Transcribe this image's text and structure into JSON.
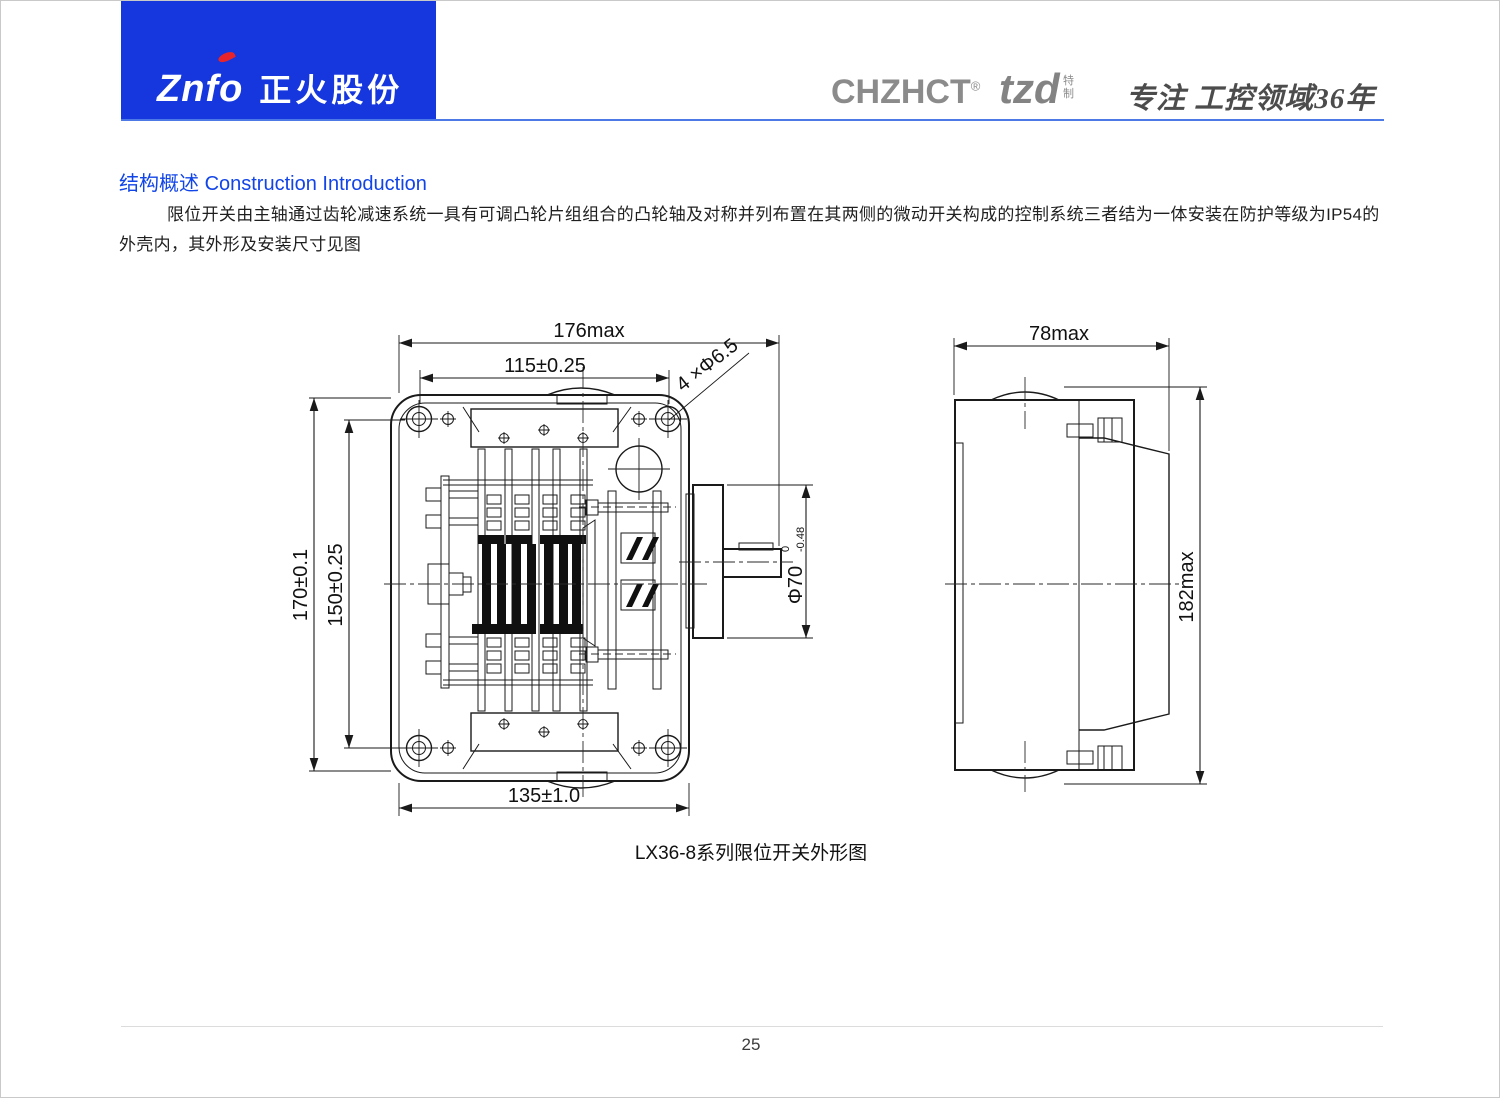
{
  "page": {
    "number": "25"
  },
  "header": {
    "logo_en": "Znfo",
    "logo_cn": "正火股份",
    "brand_primary": "CHZHCT",
    "brand_primary_reg": "®",
    "brand_secondary": "tzd",
    "brand_secondary_tag": "特制",
    "slogan": "专注 工控领域36年",
    "banner_color": "#1537dd",
    "accent_color": "#e8242a",
    "title_color": "#1245e8"
  },
  "section": {
    "title_cn": "结构概述",
    "title_en": "Construction Introduction",
    "body": "限位开关由主轴通过齿轮减速系统一具有可调凸轮片组组合的凸轮轴及对称并列布置在其两侧的微动开关构成的控制系统三者结为一体安装在防护等级为IP54的外壳内，其外形及安装尺寸见图"
  },
  "figure": {
    "caption": "LX36-8系列限位开关外形图",
    "front_view": {
      "dim_width_outer": "176max",
      "dim_width_inner": "115±0.25",
      "dim_mount_holes": "4 ×Φ6.5",
      "dim_height_outer": "170±0.1",
      "dim_height_inner": "150±0.25",
      "dim_width_bottom": "135±1.0",
      "dim_shaft": "Φ70",
      "dim_shaft_tol_upper": "0",
      "dim_shaft_tol_lower": "-0.48"
    },
    "side_view": {
      "dim_width": "78max",
      "dim_height": "182max"
    }
  }
}
